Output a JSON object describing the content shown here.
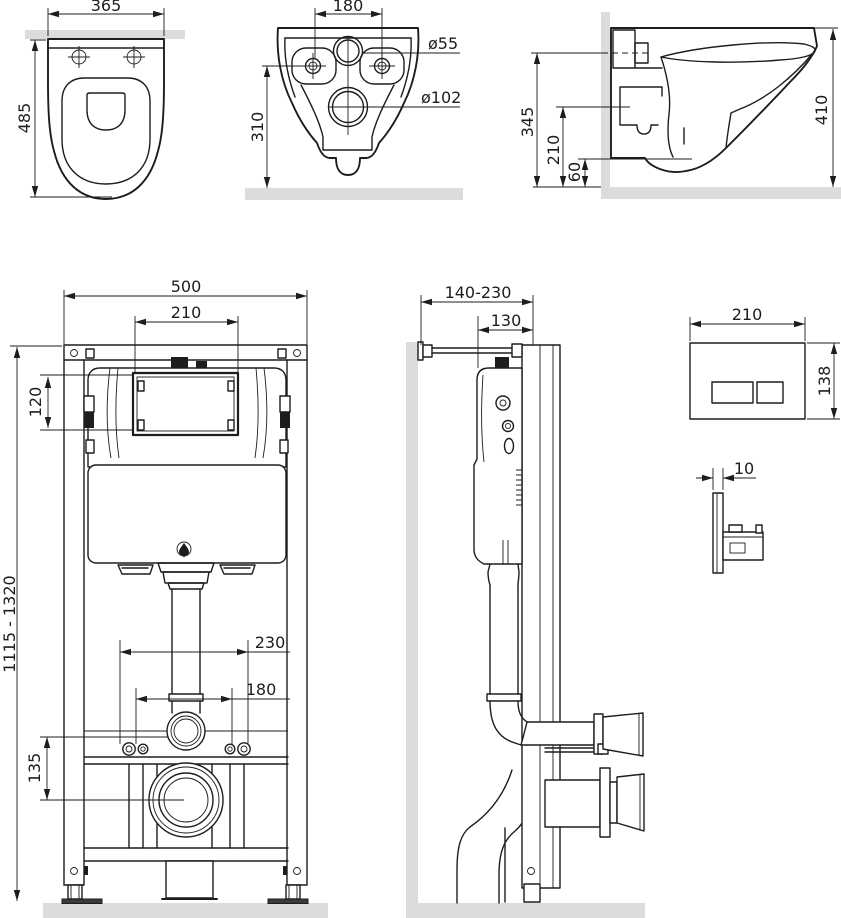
{
  "colors": {
    "line": "#1d1d1d",
    "wall_floor": "#dcdcdc",
    "background": "#ffffff"
  },
  "views": {
    "toilet_top": {
      "dims": {
        "width": "365",
        "depth": "485"
      }
    },
    "toilet_back": {
      "dims": {
        "bolt_spacing": "180",
        "inlet_diameter": "ø55",
        "outlet_diameter": "ø102",
        "outlet_height": "310"
      }
    },
    "toilet_side": {
      "dims": {
        "inlet_height": "345",
        "outlet_height": "210",
        "rim_clearance": "60",
        "depth": "410"
      }
    },
    "frame_front": {
      "dims": {
        "frame_width": "500",
        "window_width": "210",
        "window_height": "120",
        "height_range": "1115 - 1320",
        "fixing_spacing_outer": "230",
        "fixing_spacing_inner": "180",
        "drain_height": "135"
      }
    },
    "frame_side": {
      "dims": {
        "wall_offset_range": "140-230",
        "frame_depth": "130"
      }
    },
    "flush_plate": {
      "dims": {
        "width": "210",
        "height": "138",
        "thickness": "10"
      }
    }
  }
}
